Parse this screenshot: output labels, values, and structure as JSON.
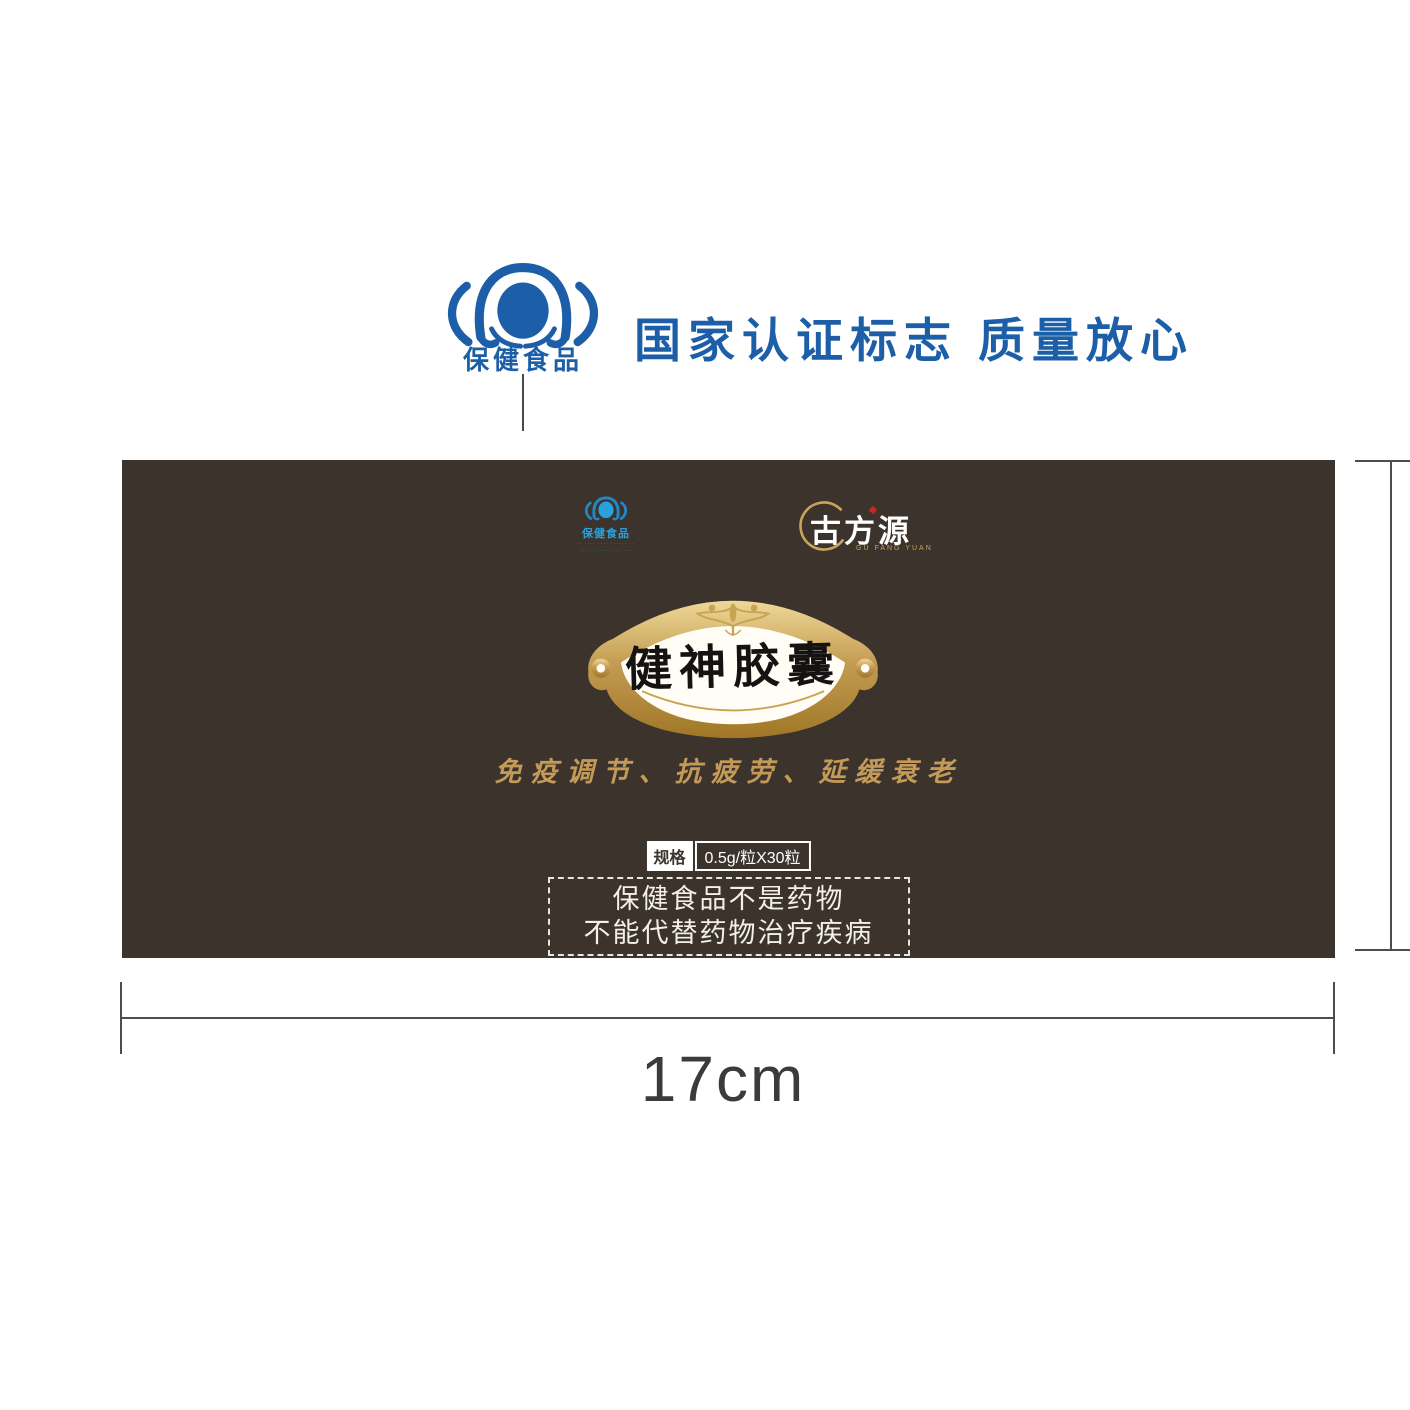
{
  "certification": {
    "logo_label": "保健食品",
    "headline": "国家认证标志 质量放心"
  },
  "package": {
    "small_logo": {
      "label": "保健食品",
      "fine_print_line1": "·· ···· ···· ······ ··",
      "fine_print_line2": "··· ··· ····· ·· ···"
    },
    "brand": {
      "name": "古方源",
      "romanized": "GU FANG YUAN"
    },
    "product_name": "健神胶囊",
    "tagline": "免疫调节、抗疲劳、延缓衰老",
    "spec": {
      "label": "规格",
      "value": "0.5g/粒X30粒"
    },
    "disclaimer": {
      "line1": "保健食品不是药物",
      "line2": "不能代替药物治疗疾病"
    }
  },
  "dimensions": {
    "width_label": "17cm"
  },
  "colors": {
    "cert_blue": "#1c5fa8",
    "bright_blue": "#2aa0dc",
    "box_brown": "#3b332c",
    "gold": "#c9a45a",
    "gold_light": "#f0e2ae",
    "red_accent": "#c42b1f",
    "dim_line_gray": "#4d4d4d"
  }
}
